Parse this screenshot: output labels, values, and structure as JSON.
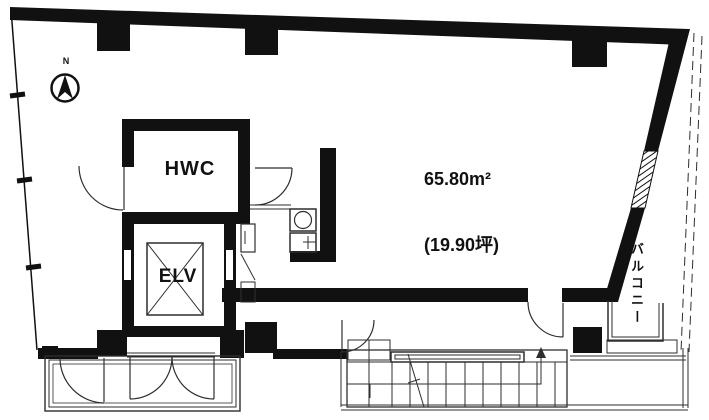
{
  "plan": {
    "north_label": "N",
    "hwc_label": "HWC",
    "elv_label": "ELV",
    "area_line1": "65.80m²",
    "area_line2": "(19.90坪)",
    "balcony_label": "バルコニー",
    "colors": {
      "wall": "#111111",
      "thin_line": "#2e2e2e",
      "background": "#ffffff"
    }
  }
}
